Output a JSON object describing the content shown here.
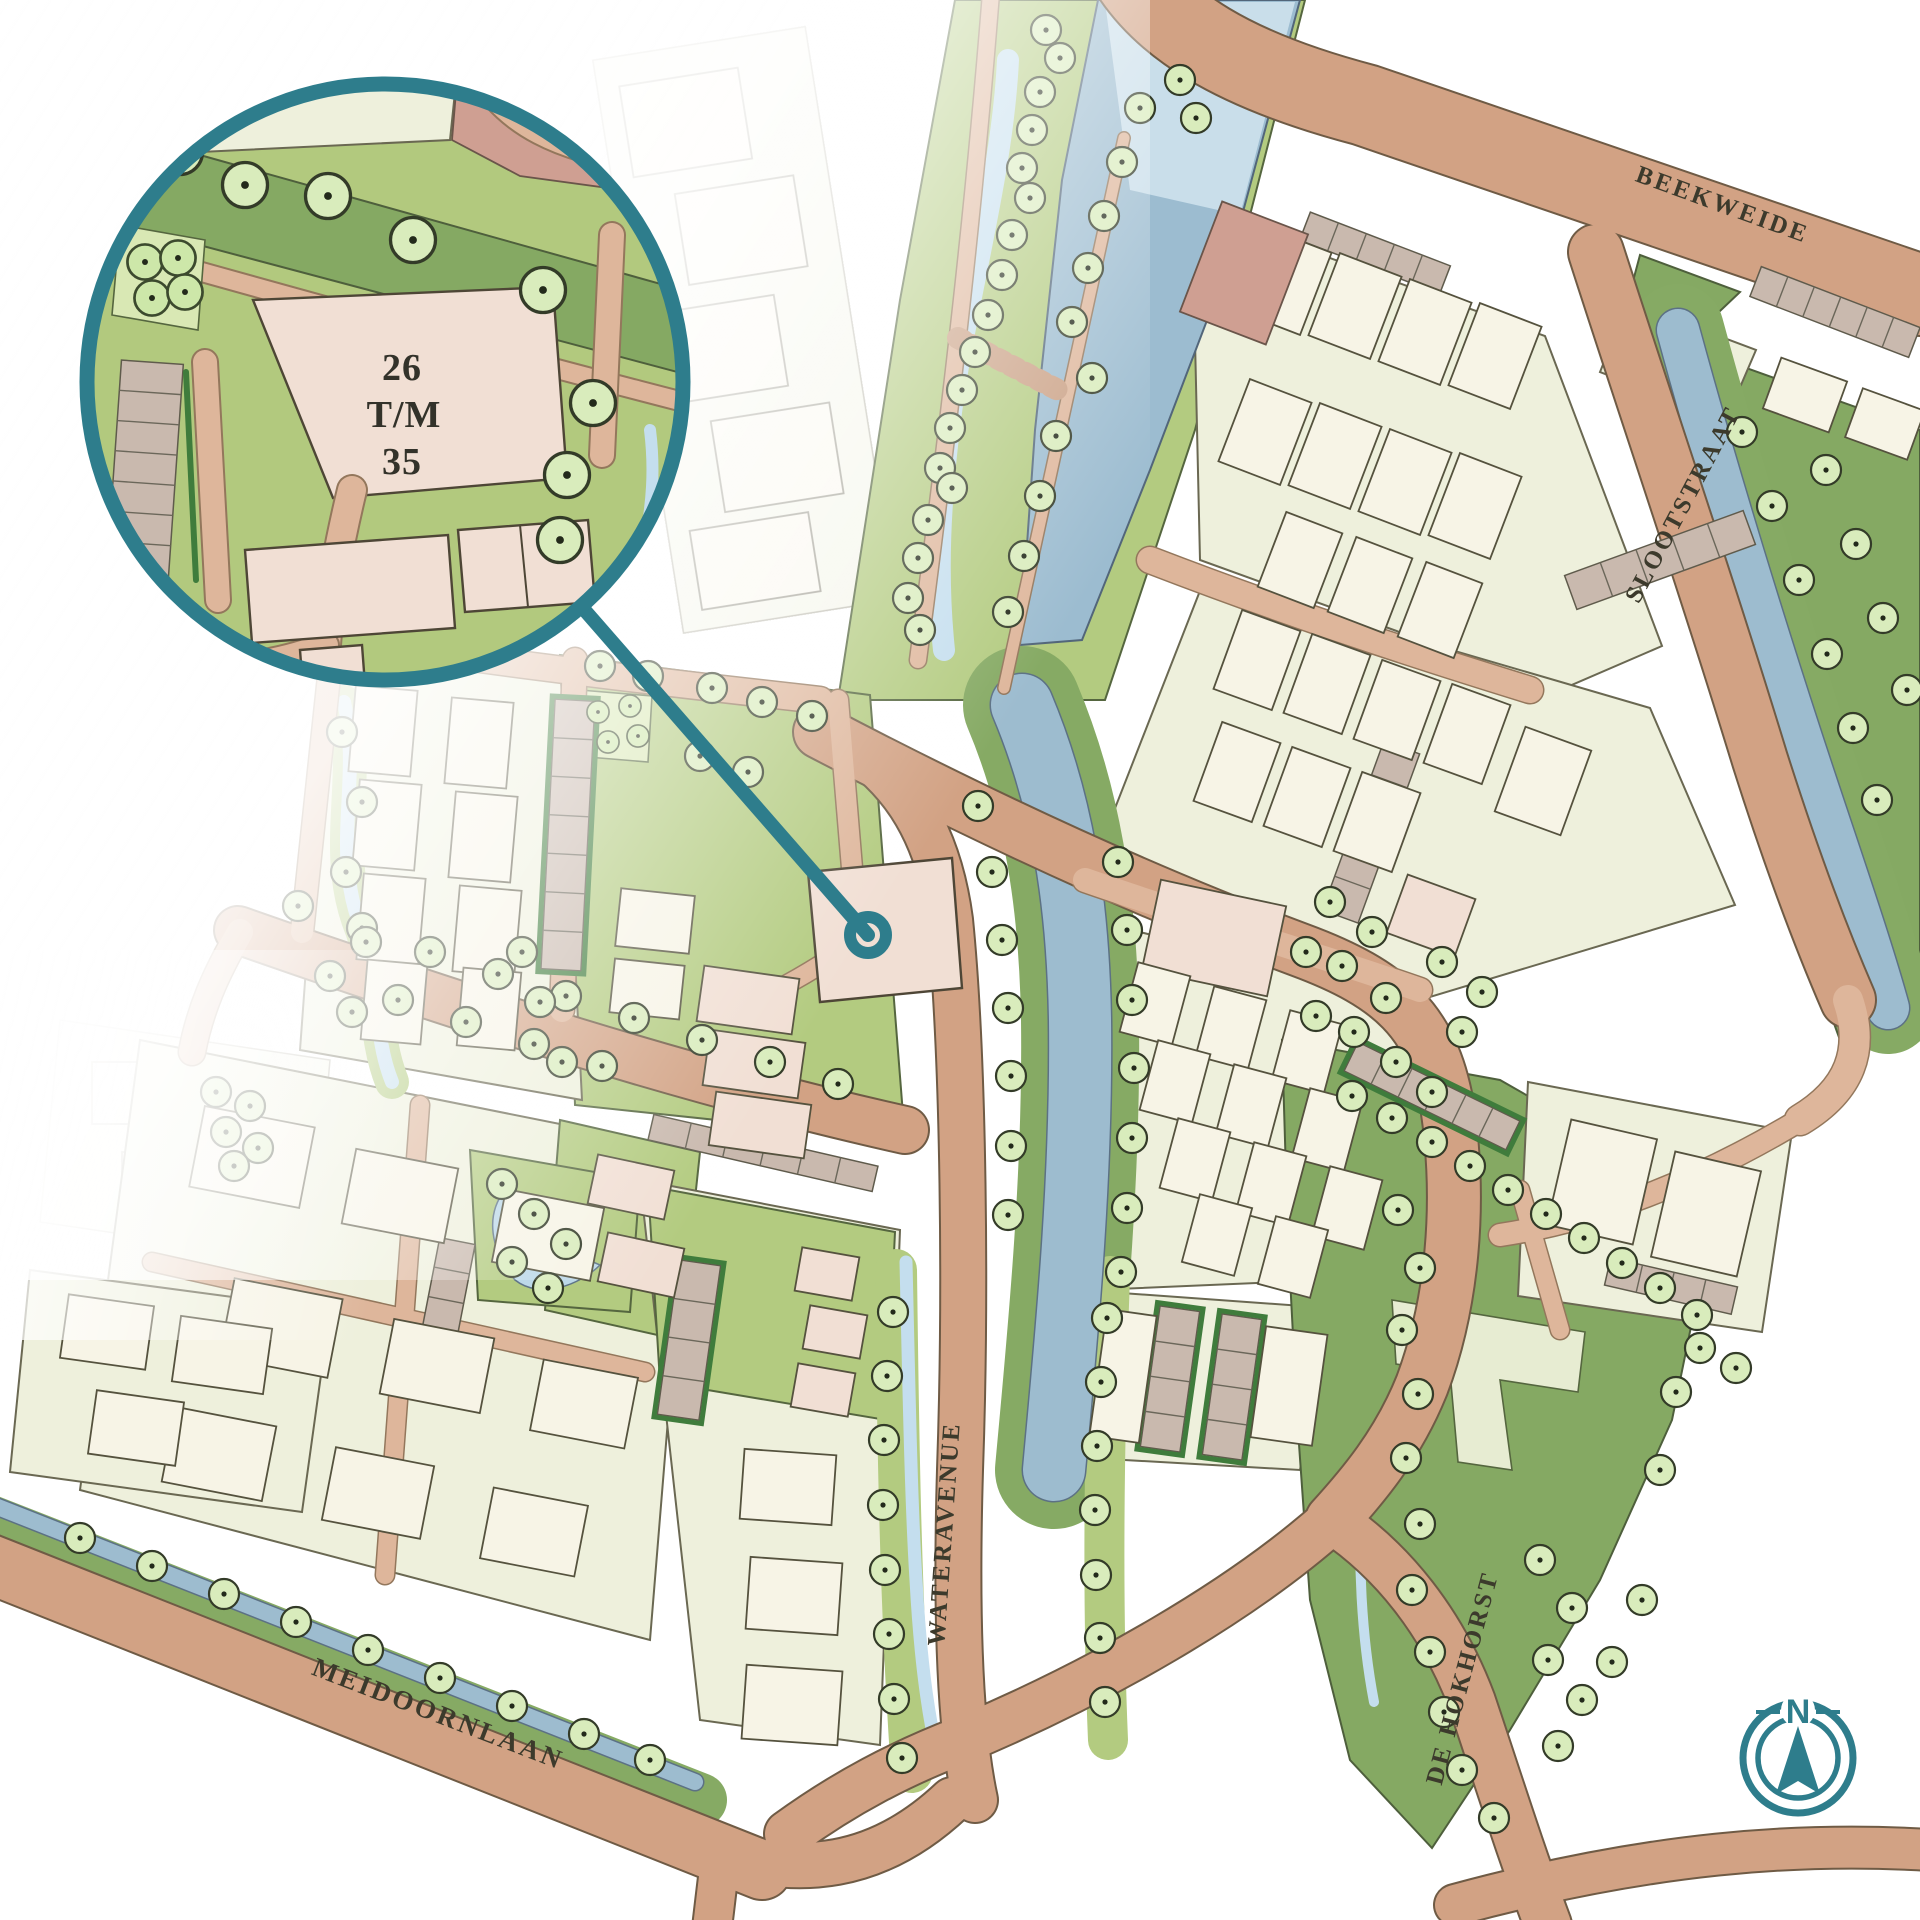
{
  "streets": {
    "beekweide": "BEEKWEIDE",
    "slootstraat": "SLOOTSTRAAT",
    "wateravenue": "WATERAVENUE",
    "meidoornlaan": "MEIDOORNLAAN",
    "de_hokhorst": "DE HOKHORST"
  },
  "magnifier": {
    "line1": "26",
    "line2": "T/M",
    "line3": "35"
  },
  "compass": {
    "north_label": "N"
  },
  "icons": {
    "magnifier": "magnifier-circle",
    "target": "target-ring",
    "compass": "compass-rose",
    "tree": "tree-symbol"
  },
  "colors": {
    "accent_teal": "#2e7d8c",
    "road": "#d2a284",
    "road_light": "#deb69b",
    "water": "#9dbccf",
    "stream": "#c4deee",
    "grass": "#85a963",
    "grass_light": "#b3cb80",
    "plot": "#eef0dc",
    "building": "#f7f4e6",
    "building_highlight": "#f1dfd4",
    "parking": "#c9b9ae",
    "hedge": "#3f7c3c",
    "tree": "#d9ecbc",
    "label_text": "#3c3a2c"
  }
}
